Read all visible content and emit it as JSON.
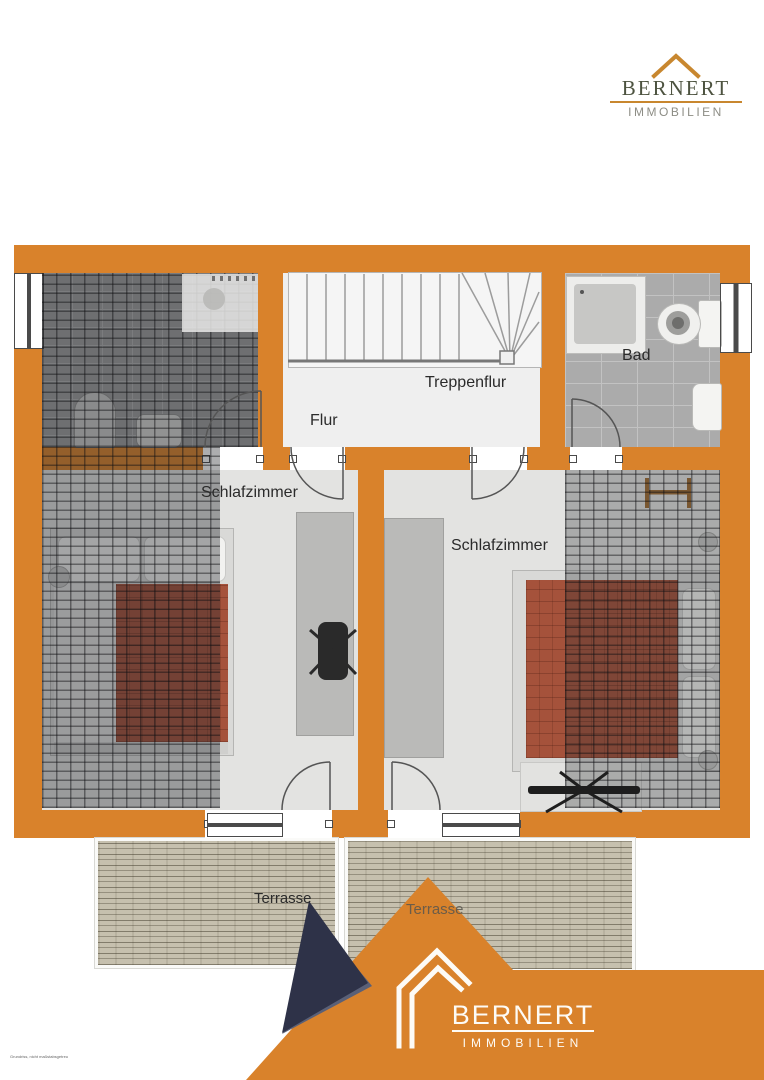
{
  "header_logo": {
    "brand": "BERNERT",
    "tagline": "IMMOBILIEN",
    "roof_color": "#C8872F",
    "brand_color": "#4D5340",
    "tagline_color": "#8D8D85"
  },
  "floorplan": {
    "wall_color": "#D9822B",
    "floor_color": "#E3E3E1",
    "tile_color": "#ABABAB",
    "bed_color": "#A5523B",
    "rooms": {
      "treppenflur": {
        "label": "Treppenflur"
      },
      "flur": {
        "label": "Flur"
      },
      "bad": {
        "label": "Bad"
      },
      "schlafzimmer_left": {
        "label": "Schlafzimmer"
      },
      "schlafzimmer_right": {
        "label": "Schlafzimmer"
      },
      "terrasse_left": {
        "label": "Terrasse"
      },
      "terrasse_right": {
        "label": "Terrasse"
      }
    }
  },
  "footer_logo": {
    "brand": "BERNERT",
    "tagline": "IMMOBILIEN",
    "orange": "#D9822B",
    "navy": "#2E3248",
    "slate": "#5A6077",
    "text_color": "#FDFBF6"
  },
  "fine_print": "Grundriss, nicht maßstabsgetreu"
}
